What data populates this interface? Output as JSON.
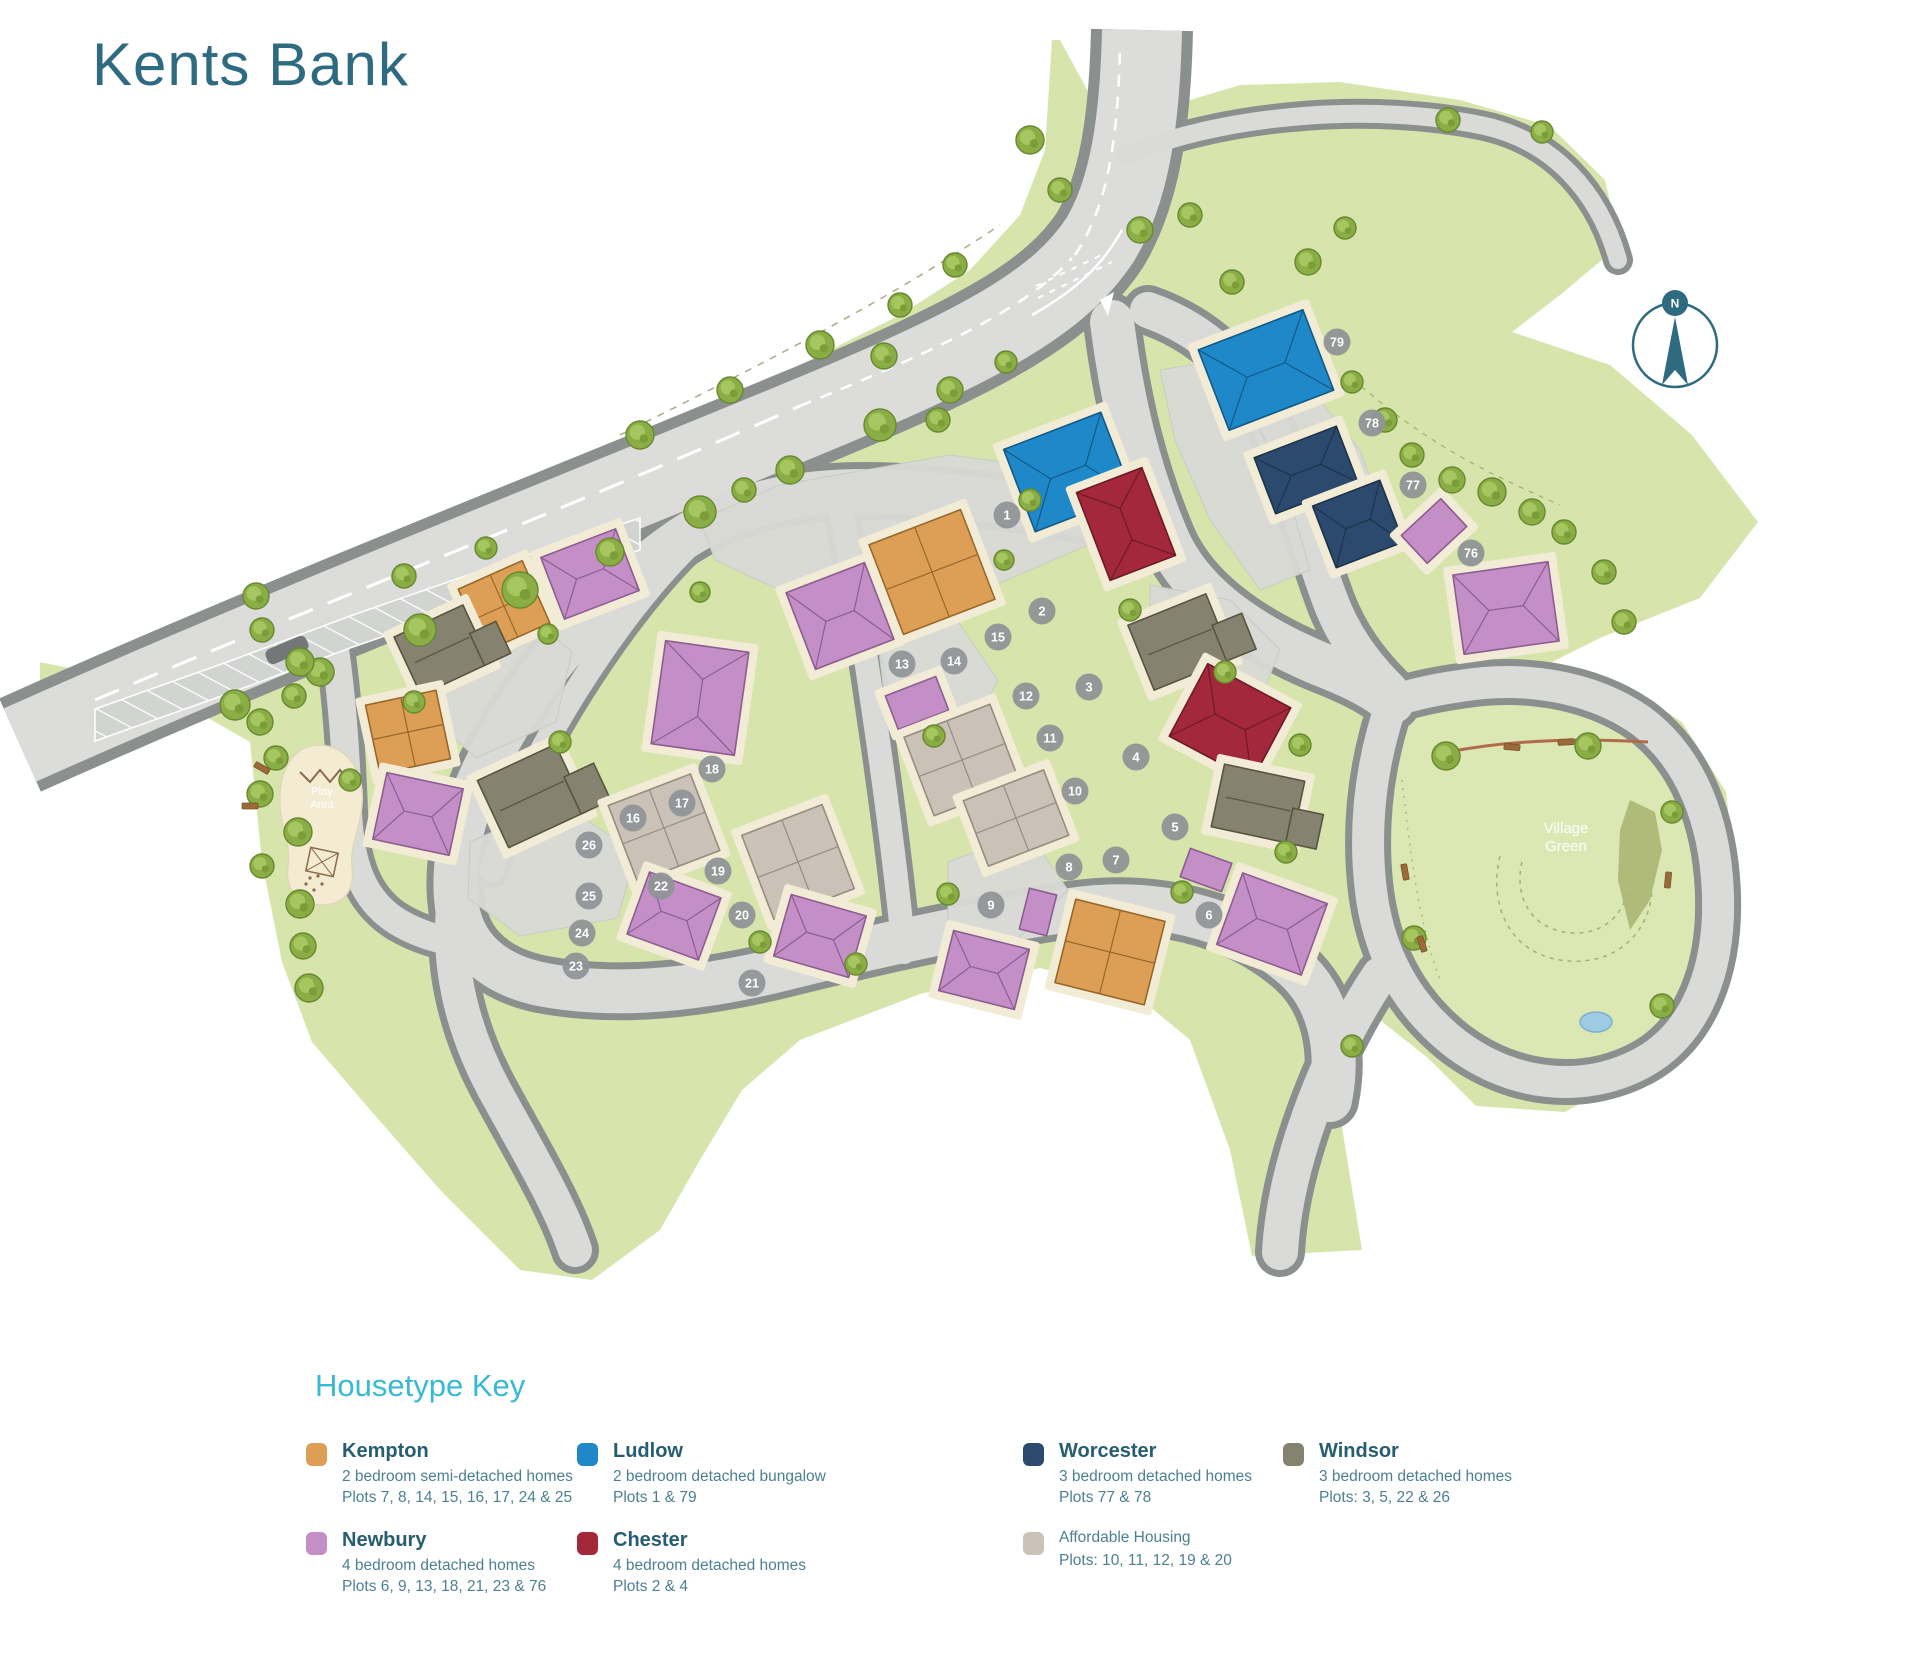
{
  "title": "Kents Bank",
  "map": {
    "compass_label": "N",
    "labels": {
      "village_green": [
        "Village",
        "Green"
      ],
      "play_area": [
        "Play",
        "Area"
      ]
    },
    "plots": [
      [
        1,
        1007,
        515
      ],
      [
        2,
        1042,
        611
      ],
      [
        3,
        1089,
        687
      ],
      [
        4,
        1136,
        757
      ],
      [
        5,
        1175,
        827
      ],
      [
        6,
        1209,
        915
      ],
      [
        7,
        1116,
        860
      ],
      [
        8,
        1069,
        867
      ],
      [
        9,
        991,
        905
      ],
      [
        10,
        1075,
        791
      ],
      [
        11,
        1050,
        738
      ],
      [
        12,
        1026,
        696
      ],
      [
        13,
        902,
        664
      ],
      [
        14,
        954,
        661
      ],
      [
        15,
        998,
        637
      ],
      [
        16,
        633,
        818
      ],
      [
        17,
        682,
        803
      ],
      [
        18,
        712,
        769
      ],
      [
        19,
        718,
        871
      ],
      [
        20,
        742,
        915
      ],
      [
        21,
        752,
        983
      ],
      [
        22,
        661,
        886
      ],
      [
        23,
        576,
        966
      ],
      [
        24,
        582,
        933
      ],
      [
        25,
        589,
        896
      ],
      [
        26,
        589,
        845
      ],
      [
        76,
        1471,
        553
      ],
      [
        77,
        1413,
        485
      ],
      [
        78,
        1372,
        423
      ],
      [
        79,
        1337,
        342
      ]
    ],
    "houses": [
      {
        "type": "ludlow",
        "roof": "cross",
        "x": 1068,
        "y": 472,
        "w": 104,
        "h": 88,
        "rot": -21
      },
      {
        "type": "chester",
        "roof": "cross",
        "x": 1126,
        "y": 524,
        "w": 70,
        "h": 94,
        "rot": -21
      },
      {
        "type": "ludlow",
        "roof": "cross",
        "x": 1266,
        "y": 370,
        "w": 112,
        "h": 86,
        "rot": -21
      },
      {
        "type": "worcester",
        "roof": "gable",
        "x": 1306,
        "y": 470,
        "w": 88,
        "h": 60,
        "rot": -21
      },
      {
        "type": "worcester",
        "roof": "gable",
        "x": 1358,
        "y": 524,
        "w": 72,
        "h": 66,
        "rot": -21
      },
      {
        "type": "newbury",
        "roof": "plain",
        "x": 1434,
        "y": 531,
        "w": 54,
        "h": 38,
        "rot": -43
      },
      {
        "type": "newbury",
        "roof": "cross",
        "x": 1506,
        "y": 608,
        "w": 96,
        "h": 80,
        "rot": -8
      },
      {
        "type": "windsor",
        "roof": "lwing",
        "x": 1180,
        "y": 642,
        "w": 84,
        "h": 70,
        "rot": -22
      },
      {
        "type": "chester",
        "roof": "cross",
        "x": 1230,
        "y": 722,
        "w": 94,
        "h": 82,
        "rot": 28
      },
      {
        "type": "windsor",
        "roof": "lwing",
        "x": 1258,
        "y": 804,
        "w": 82,
        "h": 64,
        "rot": 12
      },
      {
        "type": "newbury",
        "roof": "cross",
        "x": 1272,
        "y": 924,
        "w": 90,
        "h": 76,
        "rot": 20
      },
      {
        "type": "newbury",
        "roof": "plain",
        "x": 1206,
        "y": 870,
        "w": 44,
        "h": 30,
        "rot": 20
      },
      {
        "type": "kempton",
        "roof": "4sq",
        "x": 932,
        "y": 572,
        "w": 98,
        "h": 96,
        "rot": -21
      },
      {
        "type": "newbury",
        "roof": "cross",
        "x": 840,
        "y": 616,
        "w": 84,
        "h": 82,
        "rot": -21
      },
      {
        "type": "newbury",
        "roof": "plain",
        "x": 917,
        "y": 703,
        "w": 54,
        "h": 36,
        "rot": -21
      },
      {
        "type": "affordable",
        "roof": "4sq",
        "x": 962,
        "y": 760,
        "w": 92,
        "h": 84,
        "rot": -21
      },
      {
        "type": "affordable",
        "roof": "4sq",
        "x": 1016,
        "y": 818,
        "w": 86,
        "h": 70,
        "rot": -21
      },
      {
        "type": "affordable",
        "roof": "4sq",
        "x": 798,
        "y": 862,
        "w": 86,
        "h": 90,
        "rot": -21
      },
      {
        "type": "kempton",
        "roof": "4sq",
        "x": 1110,
        "y": 952,
        "w": 92,
        "h": 86,
        "rot": 14
      },
      {
        "type": "newbury",
        "roof": "cross",
        "x": 984,
        "y": 970,
        "w": 78,
        "h": 62,
        "rot": 14
      },
      {
        "type": "newbury",
        "roof": "plain",
        "x": 1038,
        "y": 912,
        "w": 28,
        "h": 42,
        "rot": 14
      },
      {
        "type": "newbury",
        "roof": "cross",
        "x": 590,
        "y": 574,
        "w": 80,
        "h": 66,
        "rot": -21
      },
      {
        "type": "kempton",
        "roof": "4sq",
        "x": 504,
        "y": 606,
        "w": 70,
        "h": 68,
        "rot": -24
      },
      {
        "type": "windsor",
        "roof": "lwing",
        "x": 442,
        "y": 650,
        "w": 76,
        "h": 64,
        "rot": -25
      },
      {
        "type": "kempton",
        "roof": "4sq",
        "x": 408,
        "y": 732,
        "w": 72,
        "h": 70,
        "rot": -12
      },
      {
        "type": "newbury",
        "roof": "cross",
        "x": 418,
        "y": 814,
        "w": 78,
        "h": 68,
        "rot": 12
      },
      {
        "type": "windsor",
        "roof": "lwing",
        "x": 532,
        "y": 796,
        "w": 86,
        "h": 74,
        "rot": -25
      },
      {
        "type": "newbury",
        "roof": "cross",
        "x": 700,
        "y": 698,
        "w": 84,
        "h": 104,
        "rot": 8
      },
      {
        "type": "affordable",
        "roof": "4sq",
        "x": 664,
        "y": 828,
        "w": 88,
        "h": 82,
        "rot": -21
      },
      {
        "type": "newbury",
        "roof": "cross",
        "x": 674,
        "y": 916,
        "w": 76,
        "h": 66,
        "rot": 20
      },
      {
        "type": "newbury",
        "roof": "cross",
        "x": 820,
        "y": 936,
        "w": 78,
        "h": 64,
        "rot": 16
      }
    ],
    "trees": [
      [
        235,
        705,
        15
      ],
      [
        320,
        672,
        14
      ],
      [
        420,
        630,
        16
      ],
      [
        520,
        590,
        18
      ],
      [
        610,
        552,
        14
      ],
      [
        700,
        512,
        16
      ],
      [
        790,
        470,
        14
      ],
      [
        880,
        425,
        16
      ],
      [
        950,
        390,
        13
      ],
      [
        640,
        435,
        14
      ],
      [
        730,
        390,
        13
      ],
      [
        820,
        345,
        14
      ],
      [
        900,
        305,
        12
      ],
      [
        955,
        265,
        12
      ],
      [
        1030,
        140,
        14
      ],
      [
        1060,
        190,
        12
      ],
      [
        1140,
        230,
        13
      ],
      [
        1190,
        215,
        12
      ],
      [
        1232,
        282,
        12
      ],
      [
        1308,
        262,
        13
      ],
      [
        1345,
        228,
        11
      ],
      [
        1385,
        420,
        12
      ],
      [
        1412,
        455,
        12
      ],
      [
        1452,
        480,
        13
      ],
      [
        1492,
        492,
        14
      ],
      [
        1532,
        512,
        13
      ],
      [
        1352,
        382,
        11
      ],
      [
        1564,
        532,
        12
      ],
      [
        1604,
        572,
        12
      ],
      [
        1624,
        622,
        12
      ],
      [
        1448,
        120,
        12
      ],
      [
        1542,
        132,
        11
      ],
      [
        256,
        596,
        13
      ],
      [
        262,
        630,
        12
      ],
      [
        300,
        662,
        14
      ],
      [
        294,
        696,
        12
      ],
      [
        260,
        722,
        13
      ],
      [
        276,
        758,
        12
      ],
      [
        260,
        794,
        13
      ],
      [
        298,
        832,
        14
      ],
      [
        262,
        866,
        12
      ],
      [
        300,
        904,
        14
      ],
      [
        303,
        946,
        13
      ],
      [
        309,
        988,
        14
      ],
      [
        404,
        576,
        12
      ],
      [
        486,
        548,
        11
      ],
      [
        548,
        634,
        10
      ],
      [
        414,
        702,
        11
      ],
      [
        560,
        742,
        11
      ],
      [
        350,
        780,
        11
      ],
      [
        744,
        490,
        12
      ],
      [
        884,
        356,
        13
      ],
      [
        938,
        420,
        12
      ],
      [
        1006,
        362,
        11
      ],
      [
        1030,
        500,
        11
      ],
      [
        1004,
        560,
        10
      ],
      [
        934,
        736,
        11
      ],
      [
        948,
        894,
        11
      ],
      [
        856,
        964,
        11
      ],
      [
        760,
        942,
        11
      ],
      [
        700,
        592,
        10
      ],
      [
        1130,
        610,
        11
      ],
      [
        1225,
        672,
        11
      ],
      [
        1300,
        745,
        11
      ],
      [
        1286,
        852,
        11
      ],
      [
        1182,
        892,
        11
      ],
      [
        1446,
        756,
        14
      ],
      [
        1588,
        746,
        13
      ],
      [
        1414,
        938,
        12
      ],
      [
        1672,
        812,
        11
      ],
      [
        1662,
        1006,
        12
      ],
      [
        1352,
        1046,
        11
      ]
    ],
    "benches": [
      [
        1512,
        747,
        5
      ],
      [
        1566,
        742,
        -3
      ],
      [
        1405,
        872,
        80
      ],
      [
        1422,
        944,
        72
      ],
      [
        1668,
        880,
        95
      ],
      [
        262,
        768,
        30
      ],
      [
        250,
        806,
        0
      ]
    ]
  },
  "legend": {
    "heading": "Housetype Key",
    "entries": [
      {
        "type": "kempton",
        "name": "Kempton",
        "name_bold": true,
        "lines": [
          "2 bedroom semi-detached homes",
          "Plots 7, 8, 14, 15, 16, 17, 24 & 25"
        ]
      },
      {
        "type": "ludlow",
        "name": "Ludlow",
        "name_bold": true,
        "lines": [
          "2 bedroom detached bungalow",
          "Plots 1 & 79"
        ]
      },
      {
        "type": "worcester",
        "name": "Worcester",
        "name_bold": true,
        "lines": [
          "3 bedroom detached homes",
          "Plots 77 & 78"
        ]
      },
      {
        "type": "windsor",
        "name": "Windsor",
        "name_bold": true,
        "lines": [
          "3 bedroom detached homes",
          "Plots: 3, 5, 22 & 26"
        ]
      },
      {
        "type": "newbury",
        "name": "Newbury",
        "name_bold": true,
        "lines": [
          "4 bedroom detached homes",
          "Plots 6, 9, 13, 18, 21, 23 & 76"
        ]
      },
      {
        "type": "chester",
        "name": "Chester",
        "name_bold": true,
        "lines": [
          "4 bedroom detached homes",
          "Plots 2 & 4"
        ]
      },
      {
        "type": "affordable",
        "name": "Affordable Housing",
        "name_bold": false,
        "lines": [
          "Plots: 10, 11, 12, 19 & 20"
        ]
      }
    ]
  },
  "colors": {
    "title_text": "#2f6b80",
    "legend_heading": "#3ab9d5",
    "legend_name": "#275d72",
    "legend_desc": "#4c7f91",
    "plot_marker": "#8f9397",
    "compass": "#2e6b80",
    "housetypes": {
      "kempton": {
        "fill": "#dd9f55",
        "stroke": "#96682a"
      },
      "ludlow": {
        "fill": "#1f88c8",
        "stroke": "#135a88"
      },
      "worcester": {
        "fill": "#2c4a6e",
        "stroke": "#1d3349"
      },
      "windsor": {
        "fill": "#85826f",
        "stroke": "#57553f"
      },
      "newbury": {
        "fill": "#c48fc6",
        "stroke": "#8d5d90"
      },
      "chester": {
        "fill": "#a2283a",
        "stroke": "#6e1a28"
      },
      "affordable": {
        "fill": "#cac2b6",
        "stroke": "#958d80"
      }
    },
    "green": "#d7e5ac",
    "village_green": "#dbe8b4",
    "road": "#dadbd8",
    "road_edge": "#8b8f8e",
    "cream": "#f2ecd6",
    "pond": "#9ecbe4"
  }
}
